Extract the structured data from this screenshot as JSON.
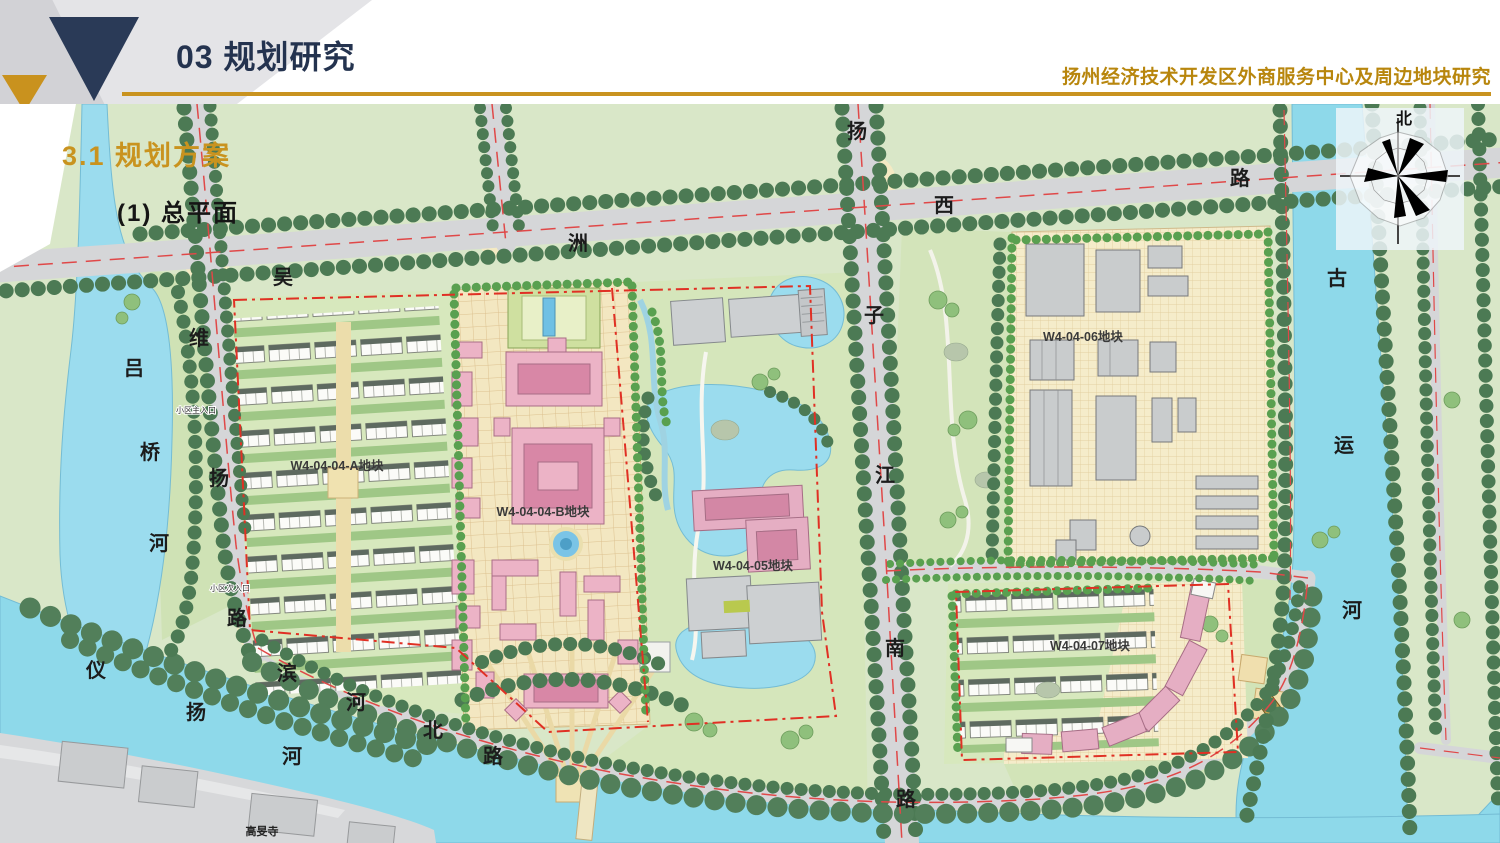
{
  "header": {
    "section_no_title": "03 规划研究",
    "doc_title": "扬州经济技术开发区外商服务中心及周边地块研究"
  },
  "section": {
    "label": "3.1 规划方案",
    "sub_label": "(1) 总平面"
  },
  "compass": {
    "north": "北"
  },
  "colors": {
    "accent_gold": "#c9931f",
    "navy": "#2a3a57",
    "map_background_green": "#d9e7c8",
    "water_blue": "#8ed9ea",
    "road_gray": "#d5d6d8",
    "boundary_red": "#e03024",
    "campus_pink": "#ecb3c6"
  },
  "map": {
    "roads": [
      {
        "name": "吴洲西路",
        "chars": [
          "吴",
          "洲",
          "西",
          "路"
        ]
      },
      {
        "name": "扬子江南路",
        "chars": [
          "扬",
          "子",
          "江",
          "南",
          "路"
        ]
      },
      {
        "name": "维扬路",
        "chars": [
          "维",
          "扬",
          "路"
        ]
      },
      {
        "name": "滨河北路",
        "chars": [
          "滨",
          "河",
          "北",
          "路"
        ]
      }
    ],
    "rivers": [
      {
        "name": "吕桥河",
        "chars": [
          "吕",
          "桥",
          "河"
        ]
      },
      {
        "name": "仪扬河",
        "chars": [
          "仪",
          "扬",
          "河"
        ]
      },
      {
        "name": "古运河",
        "chars": [
          "古",
          "运",
          "河"
        ]
      }
    ],
    "plots": [
      {
        "label": "W4-04-04-A地块"
      },
      {
        "label": "W4-04-04-B地块"
      },
      {
        "label": "W4-04-05地块"
      },
      {
        "label": "W4-04-06地块"
      },
      {
        "label": "W4-04-07地块"
      }
    ],
    "pois": [
      {
        "label": "高旻寺"
      },
      {
        "label": "小区主入口"
      },
      {
        "label": "小区次入口"
      }
    ]
  }
}
